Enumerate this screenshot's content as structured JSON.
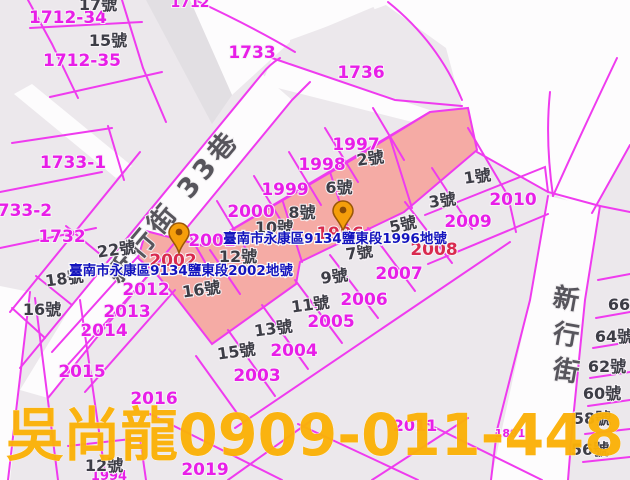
{
  "map": {
    "colors": {
      "base_parcel": "#ECE8EC",
      "road_white": "#FDFCFD",
      "road_gray": "#E2DFE3",
      "selection_fill": "#F5ABA5",
      "boundary_line": "#EF3BEF",
      "parcel_number": "#E81EE8",
      "selected_parcel_number": "#D92A4E",
      "house_number": "#3D3D46",
      "address_label": "#1414BE",
      "street_name": "#57555C",
      "watermark": "#FBB108",
      "marker_fill": "#F59E0B",
      "marker_stroke": "#9A5708"
    },
    "streets": [
      {
        "name": "新行街 33巷",
        "x": 180,
        "y": 212,
        "size": 27,
        "rotate": -50,
        "vertical": false
      },
      {
        "name": "新行街",
        "x": 567,
        "y": 308,
        "size": 26,
        "rotate": 10,
        "vertical": true
      }
    ],
    "parcel_numbers": [
      {
        "t": "1712",
        "x": 190,
        "y": 7,
        "s": 14
      },
      {
        "t": "1712-34",
        "x": 68,
        "y": 23,
        "s": 17
      },
      {
        "t": "1712-35",
        "x": 82,
        "y": 66,
        "s": 17
      },
      {
        "t": "1733",
        "x": 252,
        "y": 58,
        "s": 17
      },
      {
        "t": "1736",
        "x": 361,
        "y": 78,
        "s": 17
      },
      {
        "t": "1733-1",
        "x": 73,
        "y": 168,
        "s": 17
      },
      {
        "t": "1733-2",
        "x": 19,
        "y": 216,
        "s": 17
      },
      {
        "t": "1732",
        "x": 62,
        "y": 242,
        "s": 17
      },
      {
        "t": "1997",
        "x": 356,
        "y": 150,
        "s": 17
      },
      {
        "t": "1998",
        "x": 322,
        "y": 170,
        "s": 17
      },
      {
        "t": "1999",
        "x": 285,
        "y": 195,
        "s": 17
      },
      {
        "t": "2000",
        "x": 251,
        "y": 217,
        "s": 17
      },
      {
        "t": "2001",
        "x": 212,
        "y": 246,
        "s": 17
      },
      {
        "t": "2010",
        "x": 513,
        "y": 205,
        "s": 17
      },
      {
        "t": "2009",
        "x": 468,
        "y": 227,
        "s": 17
      },
      {
        "t": "2007",
        "x": 399,
        "y": 279,
        "s": 17
      },
      {
        "t": "2006",
        "x": 364,
        "y": 305,
        "s": 17
      },
      {
        "t": "2005",
        "x": 331,
        "y": 327,
        "s": 17
      },
      {
        "t": "2004",
        "x": 294,
        "y": 356,
        "s": 17
      },
      {
        "t": "2003",
        "x": 257,
        "y": 381,
        "s": 17
      },
      {
        "t": "2012",
        "x": 146,
        "y": 295,
        "s": 17
      },
      {
        "t": "2013",
        "x": 127,
        "y": 317,
        "s": 17
      },
      {
        "t": "2014",
        "x": 104,
        "y": 336,
        "s": 17
      },
      {
        "t": "2015",
        "x": 82,
        "y": 377,
        "s": 17
      },
      {
        "t": "2016",
        "x": 154,
        "y": 404,
        "s": 17
      },
      {
        "t": "2019",
        "x": 205,
        "y": 475,
        "s": 17
      },
      {
        "t": "2011",
        "x": 415,
        "y": 431,
        "s": 16
      },
      {
        "t": "1891",
        "x": 510,
        "y": 437,
        "s": 11
      },
      {
        "t": "1994",
        "x": 109,
        "y": 480,
        "s": 13
      }
    ],
    "selected_parcel_numbers": [
      {
        "t": "1996",
        "x": 340,
        "y": 239,
        "s": 17
      },
      {
        "t": "2002",
        "x": 173,
        "y": 266,
        "s": 17
      },
      {
        "t": "2008",
        "x": 434,
        "y": 255,
        "s": 17
      }
    ],
    "house_numbers": [
      {
        "t": "17號",
        "x": 98,
        "y": 10,
        "s": 16
      },
      {
        "t": "15號",
        "x": 108,
        "y": 46,
        "s": 16
      },
      {
        "t": "2號",
        "x": 371,
        "y": 164,
        "s": 16,
        "r": -8
      },
      {
        "t": "6號",
        "x": 339,
        "y": 193,
        "s": 16
      },
      {
        "t": "8號",
        "x": 302,
        "y": 218,
        "s": 16
      },
      {
        "t": "10號",
        "x": 274,
        "y": 233,
        "s": 16
      },
      {
        "t": "12號",
        "x": 238,
        "y": 262,
        "s": 16
      },
      {
        "t": "5號",
        "x": 404,
        "y": 230,
        "s": 16,
        "r": -12
      },
      {
        "t": "3號",
        "x": 443,
        "y": 206,
        "s": 16,
        "r": -8
      },
      {
        "t": "1號",
        "x": 478,
        "y": 182,
        "s": 16,
        "r": -8
      },
      {
        "t": "7號",
        "x": 360,
        "y": 258,
        "s": 16,
        "r": -8
      },
      {
        "t": "9號",
        "x": 335,
        "y": 282,
        "s": 16,
        "r": -8
      },
      {
        "t": "11號",
        "x": 311,
        "y": 310,
        "s": 16,
        "r": -8
      },
      {
        "t": "13號",
        "x": 274,
        "y": 334,
        "s": 16,
        "r": -8
      },
      {
        "t": "15號",
        "x": 237,
        "y": 357,
        "s": 16,
        "r": -8
      },
      {
        "t": "22號",
        "x": 117,
        "y": 255,
        "s": 16,
        "r": -8
      },
      {
        "t": "18號",
        "x": 65,
        "y": 284,
        "s": 16,
        "r": -8
      },
      {
        "t": "16號",
        "x": 42,
        "y": 315,
        "s": 16
      },
      {
        "t": "16號",
        "x": 202,
        "y": 295,
        "s": 16,
        "r": -8
      },
      {
        "t": "12號",
        "x": 104,
        "y": 471,
        "s": 16
      },
      {
        "t": "66號",
        "x": 627,
        "y": 310,
        "s": 16
      },
      {
        "t": "64號",
        "x": 614,
        "y": 342,
        "s": 16
      },
      {
        "t": "62號",
        "x": 607,
        "y": 372,
        "s": 16
      },
      {
        "t": "60號",
        "x": 602,
        "y": 399,
        "s": 16
      },
      {
        "t": "58號",
        "x": 592,
        "y": 424,
        "s": 16
      },
      {
        "t": "56號",
        "x": 590,
        "y": 455,
        "s": 16
      }
    ],
    "address_labels": [
      {
        "text": "臺南市永康區9134鹽東段1996地號",
        "x": 335,
        "y": 243,
        "s": 13.5
      },
      {
        "text": "臺南市永康區9134鹽東段2002地號",
        "x": 181,
        "y": 275,
        "s": 13.5
      }
    ],
    "markers": [
      {
        "name": "parcel-1996-pin",
        "tip_x": 343,
        "tip_y": 231
      },
      {
        "name": "parcel-2002-pin",
        "tip_x": 179,
        "tip_y": 253
      }
    ],
    "watermark": {
      "text": "吳尚龍0909-011-448",
      "x": 315,
      "y": 455,
      "size": 58,
      "length": 618
    }
  }
}
